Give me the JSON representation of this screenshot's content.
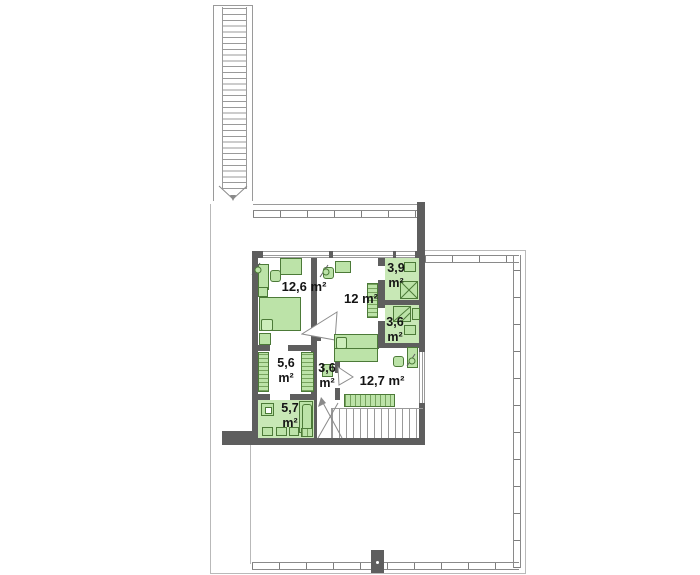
{
  "plan": {
    "title": "first-floor-plan",
    "rooms": [
      {
        "name": "bedroom-left",
        "label": "12,6 m²"
      },
      {
        "name": "bedroom-middle",
        "label": "12 m²"
      },
      {
        "name": "bathroom-top",
        "label": "3,9 m²"
      },
      {
        "name": "bathroom-right",
        "label": "3,6 m²"
      },
      {
        "name": "wardrobe-room",
        "label": "5,6 m²"
      },
      {
        "name": "hallway",
        "label": "3,6 m²"
      },
      {
        "name": "bathroom-bottom",
        "label": "5,7 m²"
      },
      {
        "name": "bedroom-right",
        "label": "12,7 m²"
      }
    ],
    "colors": {
      "wall": "#5e5e5e",
      "furniture": "#bce3a8",
      "furniture_border": "#4c7a38",
      "bathroom_floor": "#c8e8b6",
      "railing": "#8a8a8a",
      "outline": "#b9b9b9",
      "label_text": "#141414"
    }
  }
}
